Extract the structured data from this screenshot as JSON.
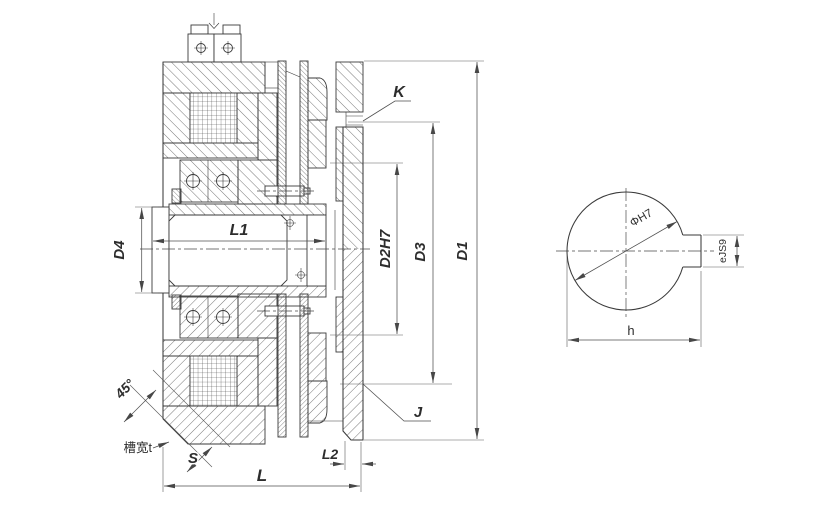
{
  "drawing": {
    "title": "Electromagnetic clutch sectional drawing with shaft-bore end view",
    "colors": {
      "line": "#3a3a3a",
      "dimension": "#4f4f4f",
      "background": "#ffffff"
    },
    "labels": {
      "K": "K",
      "J": "J",
      "L": "L",
      "L1": "L1",
      "L2": "L2",
      "D1": "D1",
      "D2": "D2H7",
      "D3": "D3",
      "D4": "D4",
      "angle45": "45°",
      "slot_width": "槽宽t",
      "S": "S",
      "bore_dia": "ΦH7",
      "key_width": "eJS9",
      "key_span": "h"
    }
  }
}
